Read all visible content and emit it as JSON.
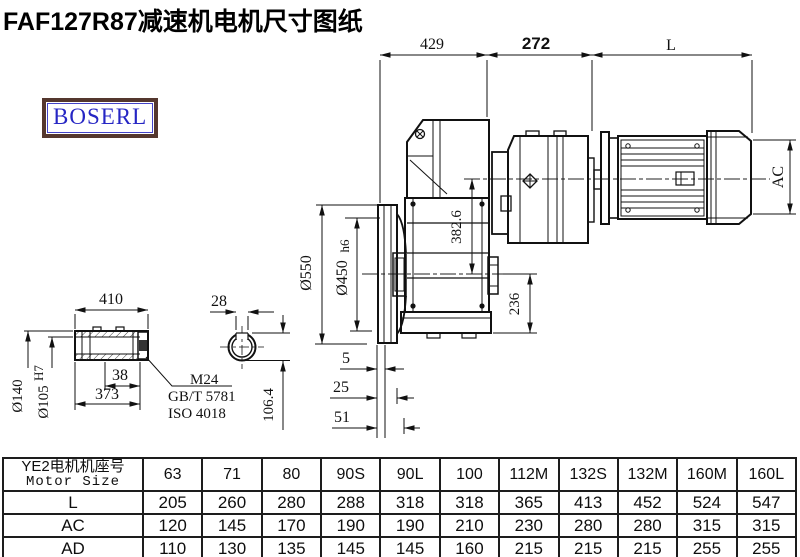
{
  "title": "FAF127R87减速机电机尺寸图纸",
  "logo": {
    "text": "BOSERL"
  },
  "dimensions": {
    "top_width_gearbox": "429",
    "top_width_adapter": "272",
    "top_width_motor": "L",
    "motor_diameter": "AC",
    "flange_od": "Ø550",
    "flange_spigot": "Ø450",
    "flange_spigot_tol": "h6",
    "axis_height": "382.6",
    "base_height": "236",
    "flange_offset_1": "5",
    "flange_offset_2": "25",
    "flange_offset_3": "51",
    "shaft_length": "410",
    "shaft_end_length": "38",
    "shaft_inner_length": "373",
    "shaft_od": "Ø140",
    "shaft_bore": "Ø105",
    "shaft_bore_tol": "H7",
    "keyway_width": "28",
    "keyway_depth": "106.4",
    "thread_note": "M24",
    "standard_1": "GB/T 5781",
    "standard_2": "ISO 4018"
  },
  "table": {
    "header_cn": "YE2电机机座号",
    "header_en": "Motor Size",
    "columns": [
      "63",
      "71",
      "80",
      "90S",
      "90L",
      "100",
      "112M",
      "132S",
      "132M",
      "160M",
      "160L"
    ],
    "rows": [
      {
        "label": "L",
        "values": [
          "205",
          "260",
          "280",
          "288",
          "318",
          "318",
          "365",
          "413",
          "452",
          "524",
          "547"
        ]
      },
      {
        "label": "AC",
        "values": [
          "120",
          "145",
          "170",
          "190",
          "190",
          "210",
          "230",
          "280",
          "280",
          "315",
          "315"
        ]
      },
      {
        "label": "AD",
        "values": [
          "110",
          "130",
          "135",
          "145",
          "145",
          "160",
          "215",
          "215",
          "215",
          "255",
          "255"
        ]
      }
    ]
  }
}
